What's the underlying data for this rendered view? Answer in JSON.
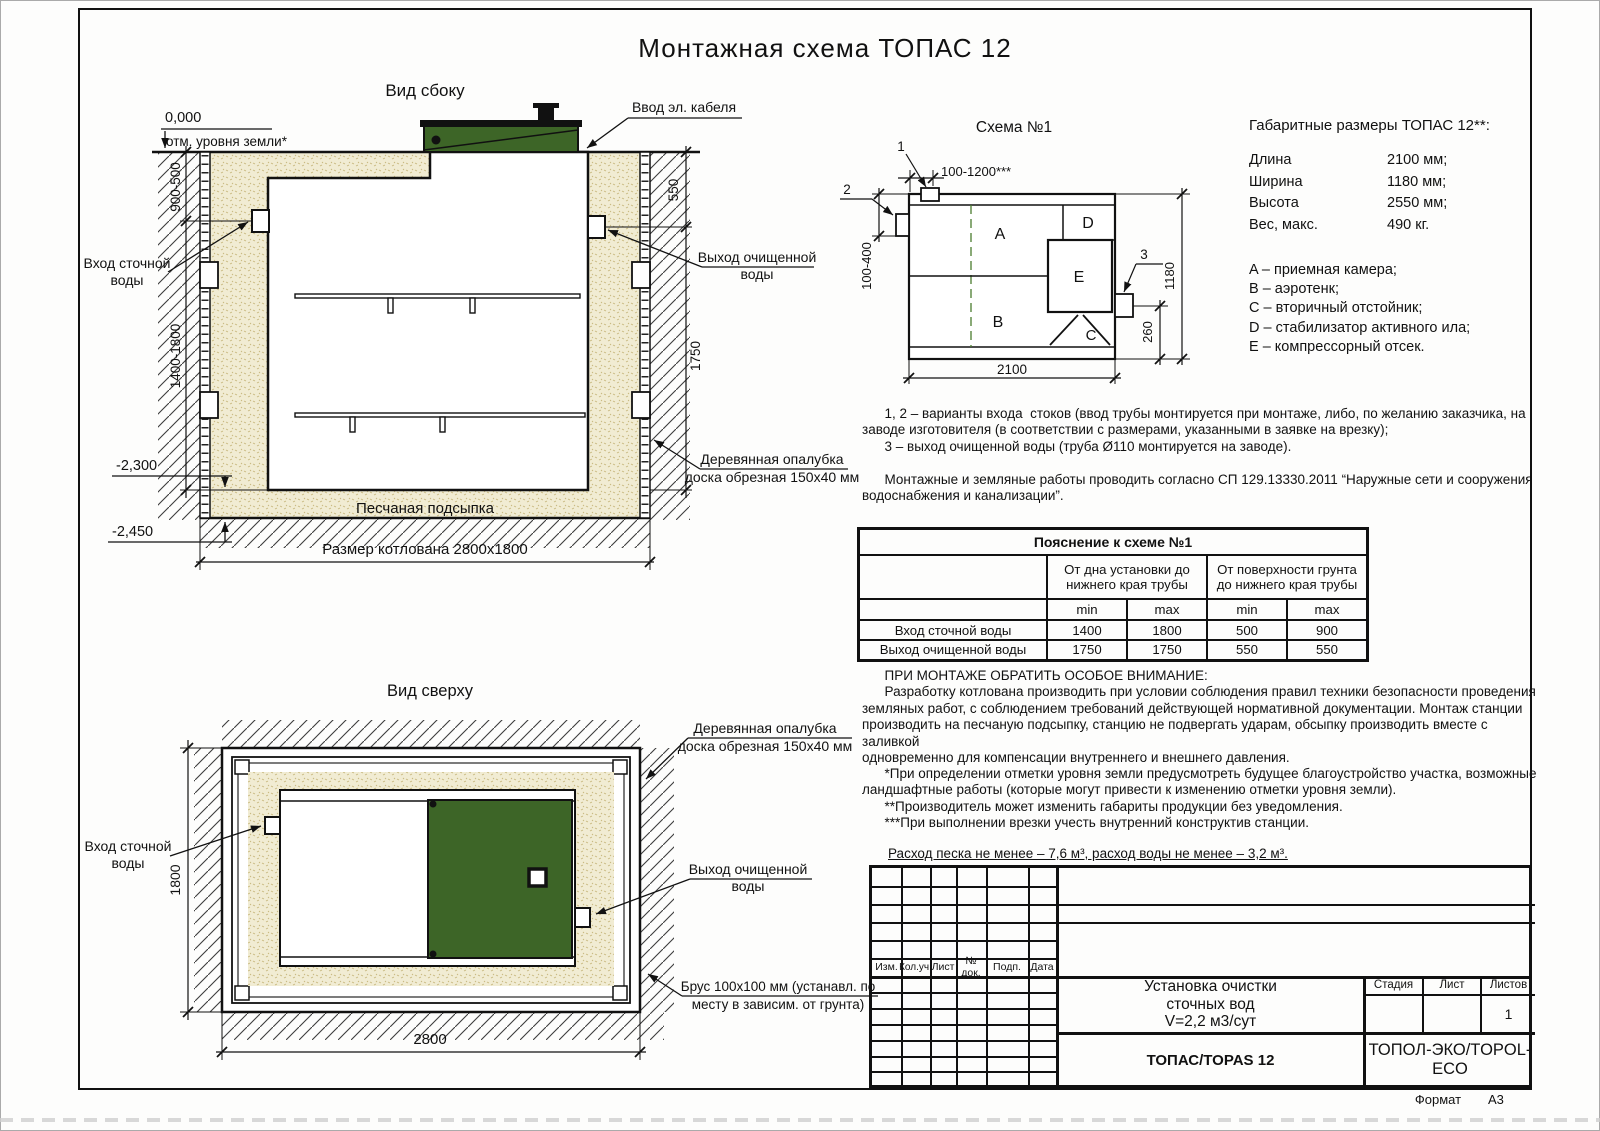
{
  "page": {
    "title": "Монтажная схема ТОПАС 12",
    "format_label": "Формат",
    "format_value": "А3"
  },
  "side_view": {
    "title": "Вид сбоку",
    "zero_mark": "0,000",
    "ground_note": "отм. уровня земли*",
    "cable_label": "Ввод эл. кабеля",
    "inlet_label_1": "Вход сточной",
    "inlet_label_2": "воды",
    "outlet_label_1": "Выход очищенной",
    "outlet_label_2": "воды",
    "formwork_label_1": "Деревянная опалубка",
    "formwork_label_2": "доска обрезная 150х40 мм",
    "sand_label": "Песчаная подсыпка",
    "pit_label": "Размер котлована 2800х1800",
    "elev_minus_2300": "-2,300",
    "elev_minus_2450": "-2,450",
    "dim_left_upper": "900-500",
    "dim_left_lower": "1400-1800",
    "dim_right_upper": "550",
    "dim_right_lower": "1750"
  },
  "scheme": {
    "title": "Схема №1",
    "callout_1": "1",
    "callout_2": "2",
    "callout_3": "3",
    "dim_top": "100-1200***",
    "dim_left": "100-400",
    "dim_right": "1180",
    "dim_outlet": "260",
    "dim_bottom": "2100",
    "comp_a": "A",
    "comp_b": "B",
    "comp_c": "C",
    "comp_d": "D",
    "comp_e": "E"
  },
  "overall": {
    "title": "Габаритные размеры ТОПАС 12**:",
    "rows": [
      {
        "label": "Длина",
        "value": "2100 мм;"
      },
      {
        "label": "Ширина",
        "value": "1180 мм;"
      },
      {
        "label": "Высота",
        "value": "2550 мм;"
      },
      {
        "label": "Вес, макс.",
        "value": "490 кг."
      }
    ],
    "legend": [
      "A – приемная камера;",
      "B – аэротенк;",
      "C – вторичный отстойник;",
      "D – стабилизатор активного ила;",
      "E – компрессорный отсек."
    ]
  },
  "notes": "      1, 2 – варианты входа  стоков (ввод трубы монтируется при монтаже, либо, по желанию заказчика, на\nзаводе изготовителя (в соответствии с размерами, указанными в заявке на врезку);\n      3 – выход очищенной воды (труба Ø110 монтируется на заводе).\n\n      Монтажные и земляные работы проводить согласно СП 129.13330.2011 “Наружные сети и сооружения\nводоснабжения и канализации”.",
  "table": {
    "title": "Пояснение к схеме №1",
    "group1": "От дна установки до\nнижнего края трубы",
    "group2": "От поверхности грунта\nдо нижнего края трубы",
    "min1": "min",
    "max1": "max",
    "min2": "min",
    "max2": "max",
    "rows": [
      {
        "name": "Вход сточной воды",
        "v": [
          "1400",
          "1800",
          "500",
          "900"
        ]
      },
      {
        "name": "Выход очищенной воды",
        "v": [
          "1750",
          "1750",
          "550",
          "550"
        ]
      }
    ]
  },
  "attention": "      ПРИ МОНТАЖЕ ОБРАТИТЬ ОСОБОЕ ВНИМАНИЕ:\n      Разработку котлована производить при условии соблюдения правил техники безопасности проведения\nземляных работ, с соблюдением требований действующей нормативной документации. Монтаж станции\nпроизводить на песчаную подсыпку, станцию не подвергать ударам, обсыпку производить вместе с заливкой\nодновременно для компенсации внутреннего и внешнего давления.",
  "footnotes": "      *При определении отметки уровня земли предусмотреть будущее благоустройство участка, возможные\nландшафтные работы (которые могут привести к изменению отметки уровня земли).\n      **Производитель может изменить габариты продукции без уведомления.\n      ***При выполнении врезки учесть внутренний конструктив станции.",
  "consumption": "Расход песка не менее – 7,6 м³, расход воды не менее – 3,2 м³.",
  "top_view": {
    "title": "Вид сверху",
    "inlet_label_1": "Вход сточной",
    "inlet_label_2": "воды",
    "formwork_label_1": "Деревянная опалубка",
    "formwork_label_2": "доска обрезная 150х40 мм",
    "outlet_label_1": "Выход очищенной",
    "outlet_label_2": "воды",
    "beam_label_1": "Брус 100х100 мм (устанавл. по",
    "beam_label_2": "месту в зависим. от грунта)",
    "dim_width": "1800",
    "dim_length": "2800"
  },
  "title_block": {
    "rev_cols": [
      "Изм.",
      "Кол.уч.",
      "Лист",
      "№ док.",
      "Подп.",
      "Дата"
    ],
    "doc_line1": "Установка очистки",
    "doc_line2": "сточных вод",
    "doc_line3": "V=2,2 м3/сут",
    "model": "ТОПАС/TOPAS 12",
    "company": "ТОПОЛ-ЭКО/TOPOL-ECO",
    "stage_label": "Стадия",
    "sheet_label": "Лист",
    "sheets_label": "Листов",
    "sheets_value": "1"
  }
}
